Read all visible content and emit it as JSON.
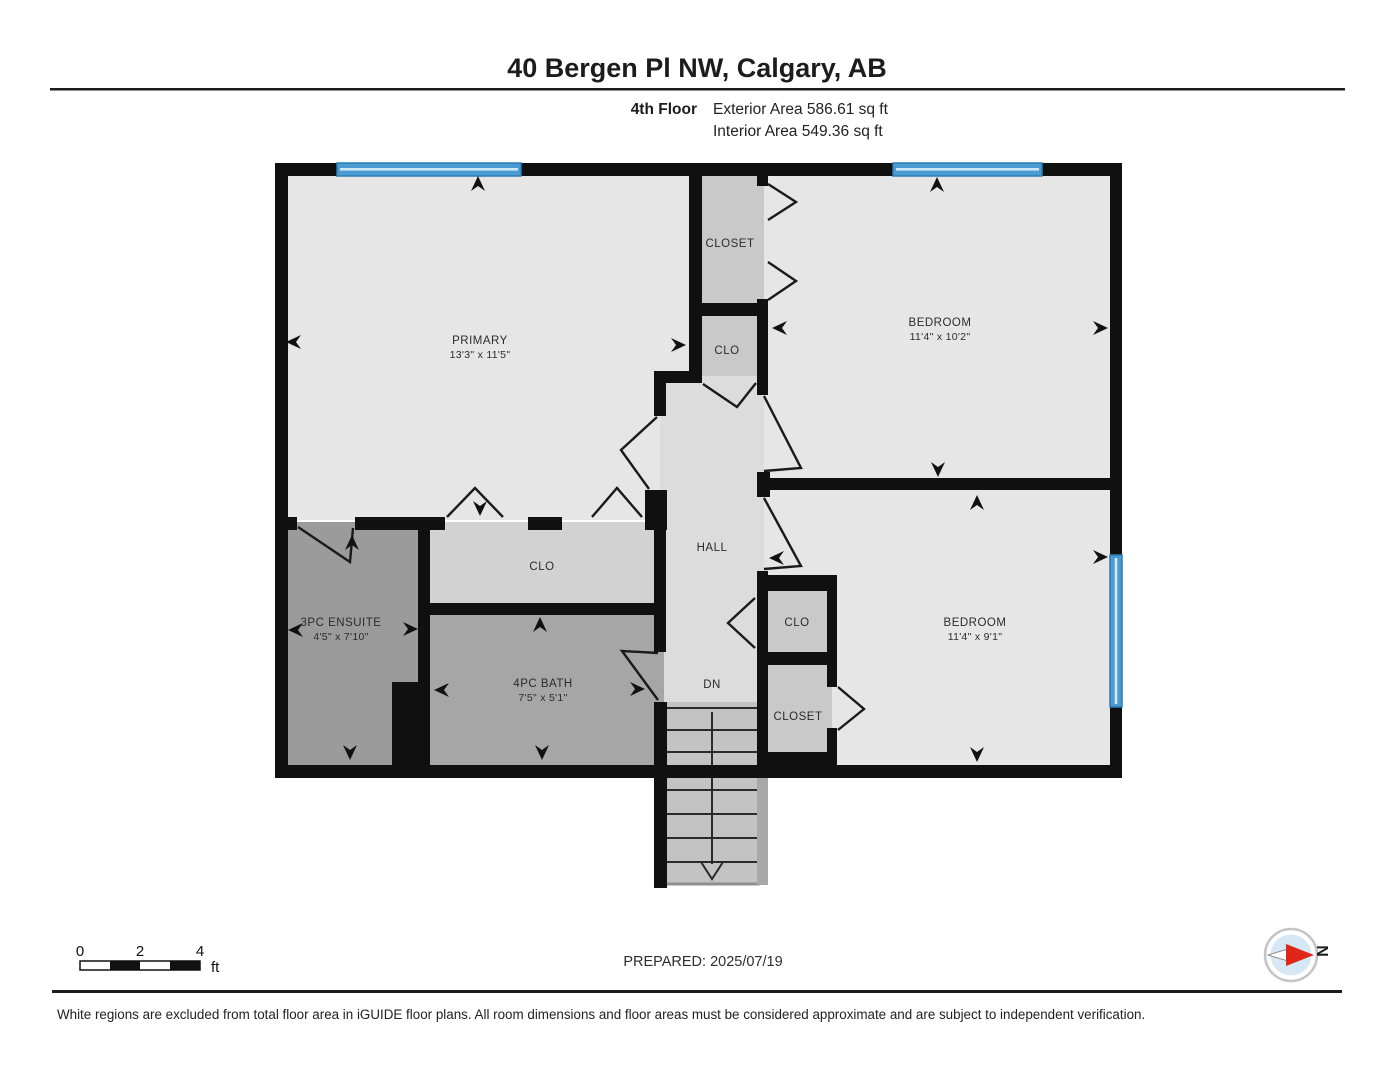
{
  "header": {
    "address": "40 Bergen Pl NW, Calgary, AB",
    "floor_label": "4th Floor",
    "exterior_area": "Exterior Area 586.61 sq ft",
    "interior_area": "Interior Area 549.36 sq ft"
  },
  "rooms": {
    "primary": {
      "name": "PRIMARY",
      "dims": "13'3\" x 11'5\""
    },
    "bedroom1": {
      "name": "BEDROOM",
      "dims": "11'4\" x 10'2\""
    },
    "bedroom2": {
      "name": "BEDROOM",
      "dims": "11'4\" x 9'1\""
    },
    "ensuite": {
      "name": "3PC ENSUITE",
      "dims": "4'5\" x 7'10\""
    },
    "bath": {
      "name": "4PC BATH",
      "dims": "7'5\" x 5'1\""
    },
    "hall": {
      "name": "HALL"
    },
    "closet_top": {
      "name": "CLOSET"
    },
    "clo_mid": {
      "name": "CLO"
    },
    "clo_primary": {
      "name": "CLO"
    },
    "clo_hall": {
      "name": "CLO"
    },
    "closet_bedroom2": {
      "name": "CLOSET"
    },
    "stairs": {
      "label": "DN"
    }
  },
  "scale_bar": {
    "tick0": "0",
    "tick2": "2",
    "tick4": "4",
    "unit": "ft"
  },
  "footer": {
    "prepared": "PREPARED: 2025/07/19",
    "compass_label": "N",
    "disclaimer": "White regions are excluded from total floor area in iGUIDE floor plans. All room dimensions and floor areas must be considered approximate and are subject to independent verification."
  },
  "colors": {
    "window_blue": "#4a9bd1",
    "window_blue_dark": "#2b7cb5",
    "window_blue_light": "#cfe7f6",
    "compass_red": "#e02619",
    "compass_disc_blue": "#d6e8f5"
  }
}
